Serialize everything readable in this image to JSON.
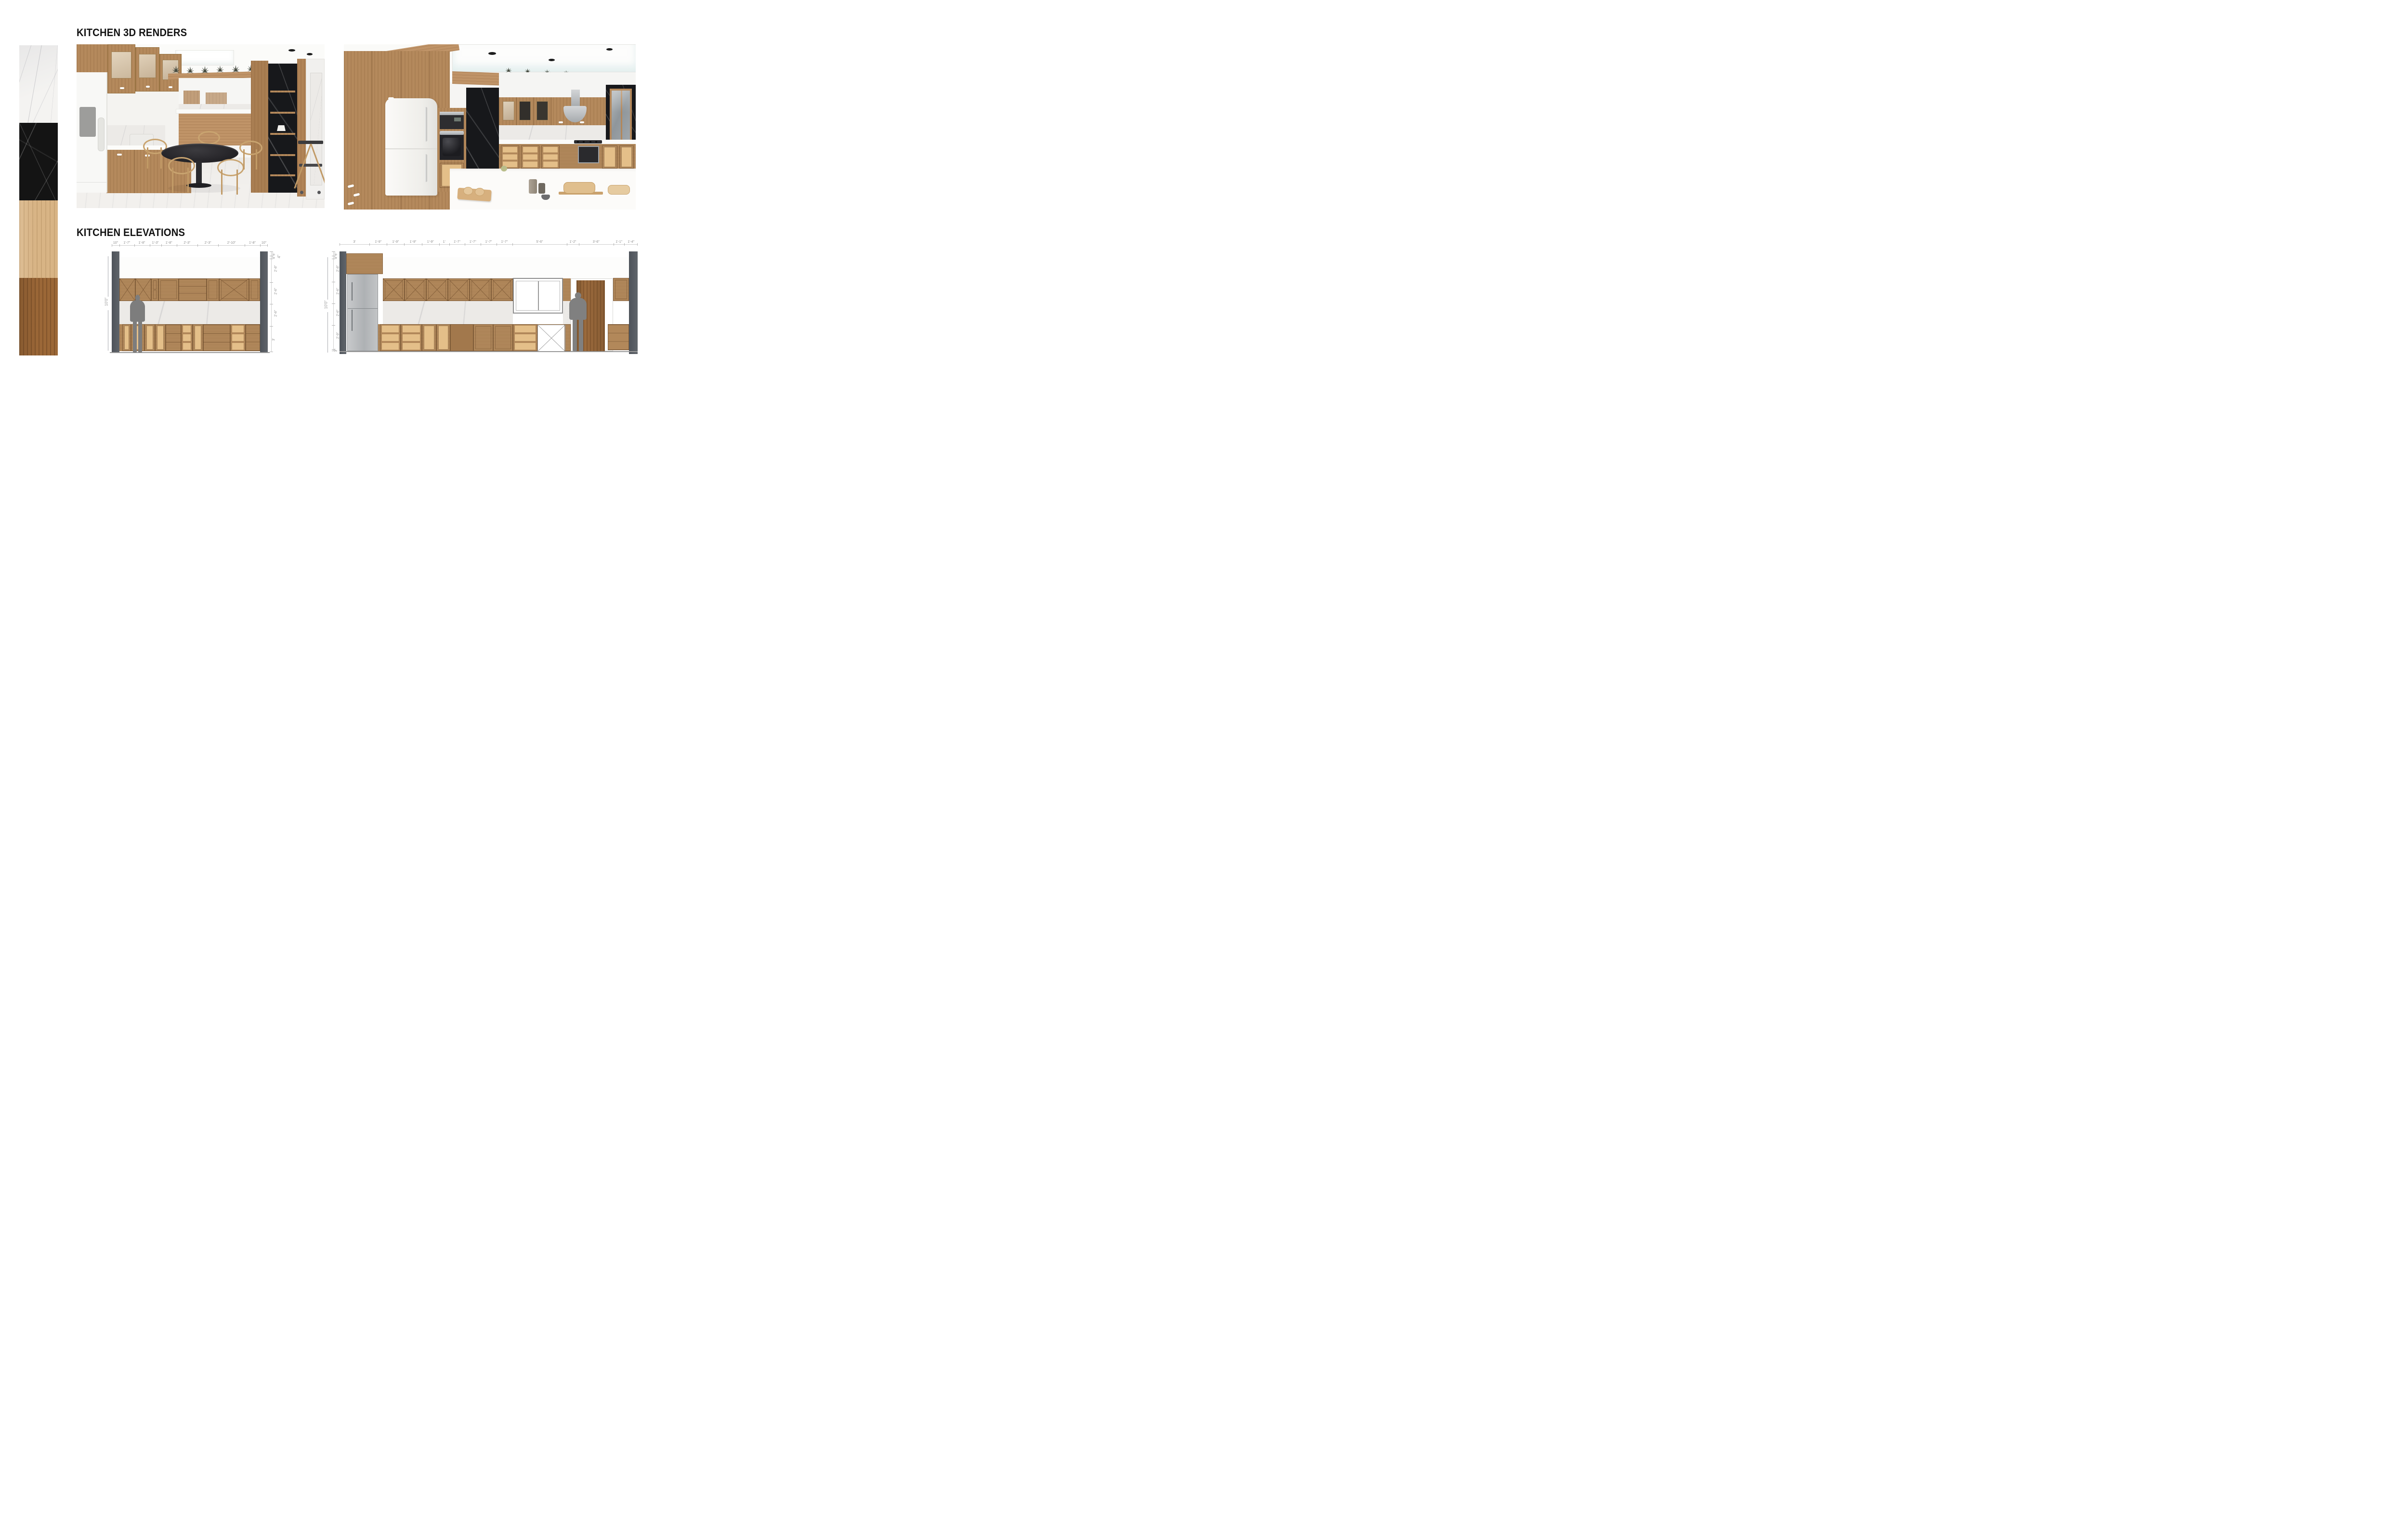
{
  "board": {
    "renders_title": "KITCHEN 3D RENDERS",
    "elevations_title": "KITCHEN ELEVATIONS"
  },
  "materials": {
    "swatches": [
      {
        "name": "white-marble",
        "color": "#f4f3f1"
      },
      {
        "name": "black-marble",
        "color": "#141414"
      },
      {
        "name": "light-wood",
        "color": "#d8b485"
      },
      {
        "name": "dark-wood",
        "color": "#9b6737"
      }
    ]
  },
  "renders": [
    {
      "label": "kitchen 3d render - dining side view"
    },
    {
      "label": "kitchen 3d render - cooking side view"
    }
  ],
  "elevations": {
    "left": {
      "total_height_label": "10'0\"",
      "ceiling_thickness_label": "4\"",
      "top_dims": [
        {
          "label": "10\"",
          "w": 10
        },
        {
          "label": "1'-7\"",
          "w": 19
        },
        {
          "label": "1'-8\"",
          "w": 20
        },
        {
          "label": "1'-3\"",
          "w": 15
        },
        {
          "label": "1'-8\"",
          "w": 20
        },
        {
          "label": "2'-3\"",
          "w": 27
        },
        {
          "label": "2'-3\"",
          "w": 27
        },
        {
          "label": "2'-10\"",
          "w": 34
        },
        {
          "label": "1'-8\"",
          "w": 20
        },
        {
          "label": "10\"",
          "w": 10
        }
      ],
      "side_dims": [
        {
          "label": "6\"",
          "w": 6
        },
        {
          "label": "4\"",
          "w": 4
        },
        {
          "label": "2'-8\"",
          "w": 32
        },
        {
          "label": "2'-6\"",
          "w": 30
        },
        {
          "label": "2'-6\"",
          "w": 30
        },
        {
          "label": "3'",
          "w": 36
        }
      ]
    },
    "right": {
      "total_height_label": "10'0\"",
      "top_dims": [
        {
          "label": "3'",
          "w": 36
        },
        {
          "label": "1'-9\"",
          "w": 21
        },
        {
          "label": "1'-9\"",
          "w": 21
        },
        {
          "label": "1'-9\"",
          "w": 21
        },
        {
          "label": "1'-9\"",
          "w": 21
        },
        {
          "label": "1'",
          "w": 12
        },
        {
          "label": "1'-7\"",
          "w": 19
        },
        {
          "label": "1'-7\"",
          "w": 19
        },
        {
          "label": "1'-7\"",
          "w": 19
        },
        {
          "label": "1'-7\"",
          "w": 19
        },
        {
          "label": "5'-6\"",
          "w": 66
        },
        {
          "label": "1'-2\"",
          "w": 14
        },
        {
          "label": "3'-6\"",
          "w": 42
        },
        {
          "label": "1'-1\"",
          "w": 13
        },
        {
          "label": "1'-4\"",
          "w": 16
        }
      ],
      "side_dims": [
        {
          "label": "6\"",
          "w": 6
        },
        {
          "label": "4\"",
          "w": 4
        },
        {
          "label": "2'-8\"",
          "w": 32
        },
        {
          "label": "2'-6\"",
          "w": 30
        },
        {
          "label": "2'-6\"",
          "w": 30
        },
        {
          "label": "2'-9\"",
          "w": 33
        },
        {
          "label": "3\"",
          "w": 3
        }
      ]
    }
  }
}
